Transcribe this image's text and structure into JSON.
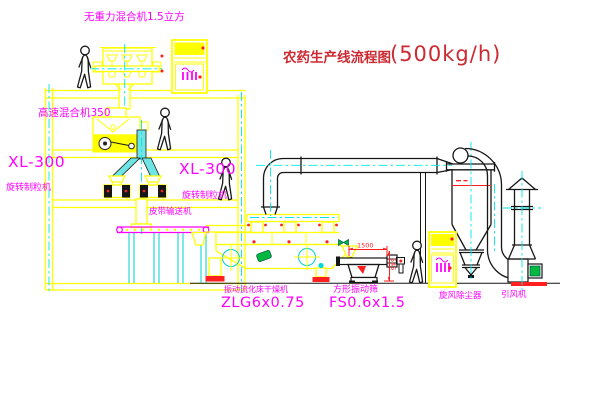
{
  "title": {
    "text": "农药生产线流程图",
    "capacity": "(500kg/h)"
  },
  "labels": {
    "gravity_mixer": "无重力混合机1.5立方",
    "high_speed_mixer": "高速混合机350",
    "granulator_left_model": "XL-300",
    "granulator_left_name": "旋转制粒机",
    "granulator_right_model": "XL-300",
    "granulator_right_name": "旋转制粒机",
    "belt_conveyor": "皮带输送机",
    "dryer_name": "振动流化床干燥机",
    "dryer_model": "ZLG6x0.75",
    "sieve_name": "方形振动筛",
    "sieve_model": "FS0.6x1.5",
    "cyclone": "旋风除尘器",
    "fan": "引风机"
  },
  "dimensions": {
    "sieve_length": "1500",
    "sieve_height": "545"
  },
  "colors": {
    "line_yellow": "#FFFF00",
    "centerline_cyan": "#00E8E8",
    "label_magenta": "#FF00FF",
    "title_red": "#CC2A33",
    "dimension_red": "#FF1F1F",
    "pipe_cyan": "#6FE4E4",
    "valve_green": "#00B840",
    "background": "#FFFFFF"
  }
}
